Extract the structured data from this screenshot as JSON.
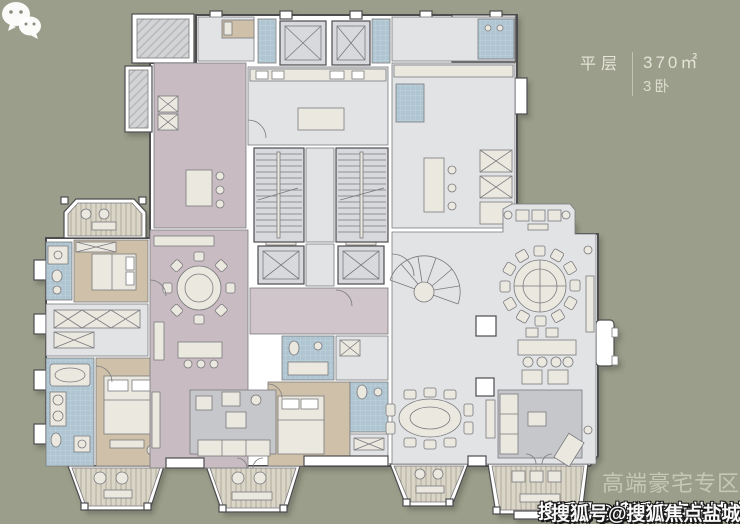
{
  "title_block": {
    "type_label": "平层",
    "area": "370㎡",
    "bedrooms": "3卧"
  },
  "watermarks": {
    "section_label": "高端豪宅专区",
    "account_label": "搜狐号@搜狐焦点盐城站",
    "icon": "wechat-icon"
  },
  "palette": {
    "bg": "#9a9e8a",
    "floor": "#e2e3e5",
    "floorDim": "#d7d9dc",
    "mauve": "#c8bcc2",
    "mauveLight": "#cfc5ca",
    "tan": "#cfc1a9",
    "blue": "#afc6d2",
    "wall": "#ffffff",
    "line": "#7a7a7e",
    "lineDark": "#4d4d50",
    "furn": "#ebe8e0",
    "rug": "#c6c7cb",
    "deck": "#d9d5c7",
    "deckStripe": "#b8b3a3",
    "hatch": "#d3d4d6",
    "hatchLine": "#b4b6b9",
    "tileLine": "#cfdde5",
    "titleText": "#e5e3d7",
    "sectionText": "#c9ccbb",
    "accountText": "#ffffff",
    "accountOutline": "#141414"
  },
  "floorplan": {
    "legend": [
      {
        "type": "living-dining",
        "colorKey": "mauve"
      },
      {
        "type": "bedroom",
        "colorKey": "tan",
        "count": 3
      },
      {
        "type": "bathroom",
        "colorKey": "blue"
      },
      {
        "type": "kitchen-core",
        "colorKey": "floor"
      },
      {
        "type": "balcony-deck",
        "colorKey": "deck"
      }
    ],
    "inventory": {
      "elevators": 4,
      "straight_staircases": 2,
      "curved_staircases": 1,
      "bedrooms": 3,
      "round_dining_tables": 2,
      "oval_dining_tables": 1,
      "bay_balconies": 5
    }
  }
}
